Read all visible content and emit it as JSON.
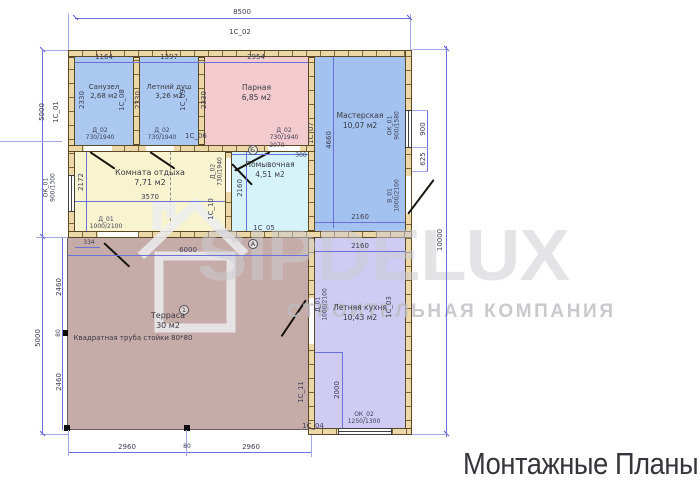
{
  "title": "Монтажные Планы",
  "watermark": {
    "brand": "SIPDELUX",
    "subtitle": "СТРОИТЕЛЬНАЯ КОМПАНИЯ"
  },
  "rooms": {
    "sanuzel": {
      "name": "Санузел",
      "area": "2,68 м2"
    },
    "dush": {
      "name": "Летний душ",
      "area": "3,26 м2"
    },
    "parnaya": {
      "name": "Парная",
      "area": "6,85 м2"
    },
    "masterskaya": {
      "name": "Мастерская",
      "area": "10,07 м2"
    },
    "otdyha": {
      "name": "Комната отдыха",
      "area": "7,71 м2"
    },
    "pomyvochnaya": {
      "name": "Помывочная",
      "area": "4,51 м2"
    },
    "terrasa": {
      "name": "Терраса",
      "area": "30 м2",
      "note": "Квадратная труба стойки 80*80"
    },
    "kuhnya": {
      "name": "Летняя кухня",
      "area": "10,43 м2"
    }
  },
  "dims": {
    "total_width": "8500",
    "height_right": "10000",
    "height_upper": "5000",
    "height_lower": "5000",
    "san_w": "1164",
    "dush_w": "1397",
    "par_w": "2954",
    "san_h": "2330",
    "dush_h": "2330",
    "par_h": "2330",
    "otdyh_h": "2172",
    "otdyh_w": "3570",
    "pom_h": "2160",
    "pom_w": "2070",
    "pom_off": "300",
    "mast_h": "4660",
    "mast_w": "2160",
    "win_right_h": "900",
    "win_right_off": "625",
    "ter_off": "334",
    "ter_w": "6000",
    "ter_h1": "2460",
    "post": "80",
    "ter_h2": "2460",
    "ter_b1": "2960",
    "ter_b2": "2960",
    "kuh_w": "2160",
    "kuh_d": "2000"
  },
  "panels": {
    "p01": "1С_01",
    "p02": "1С_02",
    "p03": "1С_03",
    "p04": "1С_04",
    "p05": "1С_05",
    "p06": "1С_06",
    "p07": "1С_07",
    "p08": "1С_08",
    "p09": "1С_09",
    "p10": "1С_10",
    "p11": "1С_11"
  },
  "openings": {
    "d02_name": "Д_02",
    "d02_size": "730/1940",
    "d01_name": "Д_01",
    "d01_size": "1000/2100",
    "v01_name": "В_01",
    "v01_size": "1000/2100",
    "ok01_name": "ОК_01",
    "ok01_left_size": "900/1300",
    "ok01_right_size": "900/1580",
    "ok02_name": "ОК_02",
    "ok02_size": "1250/1300"
  },
  "markers": {
    "axis_a": "А",
    "axis_b": "Б",
    "post_marker": "1"
  }
}
